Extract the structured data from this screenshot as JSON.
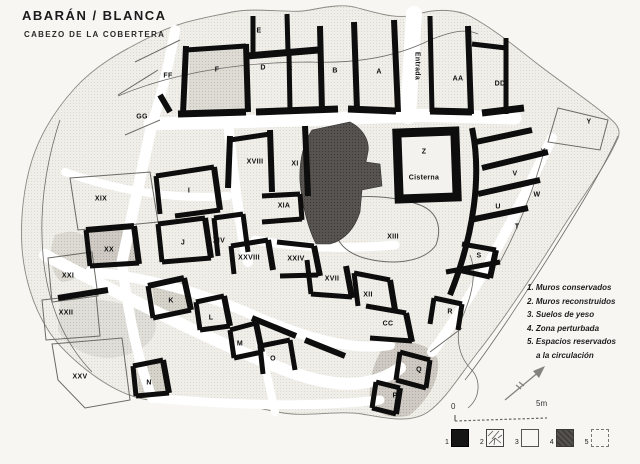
{
  "title": "ABARÁN / BLANCA",
  "subtitle": "CABEZO DE LA COBERTERA",
  "legend": {
    "items": [
      "1. Muros conservados",
      "2. Muros reconstruidos",
      "3. Suelos de yeso",
      "4. Zona perturbada",
      "5. Espacios reservados",
      "a la circulación"
    ]
  },
  "swatches": [
    {
      "num": "1",
      "type": "muros-conservados-solid-black"
    },
    {
      "num": "2",
      "type": "muros-reconstruidos-cracked"
    },
    {
      "num": "3",
      "type": "suelos-de-yeso-plain"
    },
    {
      "num": "4",
      "type": "zona-perturbada-dark"
    },
    {
      "num": "5",
      "type": "espacios-circulacion-dotted"
    }
  ],
  "scale": {
    "start": "0",
    "end": "5m"
  },
  "colors": {
    "wall": "#0d0d0d",
    "dark_zone": "#565250",
    "paper": "#f7f6f3",
    "street": "#ffffff"
  },
  "map": {
    "entrada_label": "Entrada",
    "cistern_label": "Cisterna",
    "rooms": [
      {
        "label": "FF",
        "x": 168,
        "y": 76
      },
      {
        "label": "F",
        "x": 217,
        "y": 70
      },
      {
        "label": "E",
        "x": 259,
        "y": 31
      },
      {
        "label": "D",
        "x": 263,
        "y": 68
      },
      {
        "label": "C",
        "x": 290,
        "y": 69
      },
      {
        "label": "B",
        "x": 335,
        "y": 71
      },
      {
        "label": "A",
        "x": 379,
        "y": 72
      },
      {
        "label": "Entrada",
        "x": 417,
        "y": 66,
        "rot": 90
      },
      {
        "label": "AA",
        "x": 458,
        "y": 79
      },
      {
        "label": "DD",
        "x": 500,
        "y": 84
      },
      {
        "label": "GG",
        "x": 142,
        "y": 117
      },
      {
        "label": "Y",
        "x": 589,
        "y": 122
      },
      {
        "label": "X",
        "x": 543,
        "y": 152
      },
      {
        "label": "V",
        "x": 515,
        "y": 174
      },
      {
        "label": "W",
        "x": 537,
        "y": 195
      },
      {
        "label": "U",
        "x": 498,
        "y": 207
      },
      {
        "label": "T",
        "x": 517,
        "y": 227
      },
      {
        "label": "S",
        "x": 479,
        "y": 256
      },
      {
        "label": "R",
        "x": 450,
        "y": 312
      },
      {
        "label": "XVIII",
        "x": 255,
        "y": 162
      },
      {
        "label": "XI",
        "x": 295,
        "y": 164
      },
      {
        "label": "Z",
        "x": 424,
        "y": 152
      },
      {
        "label": "Cisterna",
        "x": 424,
        "y": 178
      },
      {
        "label": "XIA",
        "x": 284,
        "y": 206
      },
      {
        "label": "XIII",
        "x": 393,
        "y": 237
      },
      {
        "label": "XIX",
        "x": 101,
        "y": 199
      },
      {
        "label": "I",
        "x": 189,
        "y": 191
      },
      {
        "label": "XX",
        "x": 109,
        "y": 250
      },
      {
        "label": "J",
        "x": 183,
        "y": 243
      },
      {
        "label": "XIV",
        "x": 219,
        "y": 241
      },
      {
        "label": "XXI",
        "x": 68,
        "y": 276
      },
      {
        "label": "XXII",
        "x": 66,
        "y": 313
      },
      {
        "label": "XXV",
        "x": 80,
        "y": 377
      },
      {
        "label": "K",
        "x": 171,
        "y": 301
      },
      {
        "label": "L",
        "x": 211,
        "y": 318
      },
      {
        "label": "M",
        "x": 240,
        "y": 344
      },
      {
        "label": "N",
        "x": 149,
        "y": 383
      },
      {
        "label": "O",
        "x": 273,
        "y": 359
      },
      {
        "label": "XXVIII",
        "x": 249,
        "y": 258
      },
      {
        "label": "XXIV",
        "x": 296,
        "y": 259
      },
      {
        "label": "XVII",
        "x": 332,
        "y": 279
      },
      {
        "label": "XII",
        "x": 368,
        "y": 295
      },
      {
        "label": "CC",
        "x": 388,
        "y": 324
      },
      {
        "label": "Q",
        "x": 419,
        "y": 370
      },
      {
        "label": "P",
        "x": 395,
        "y": 396
      }
    ]
  }
}
